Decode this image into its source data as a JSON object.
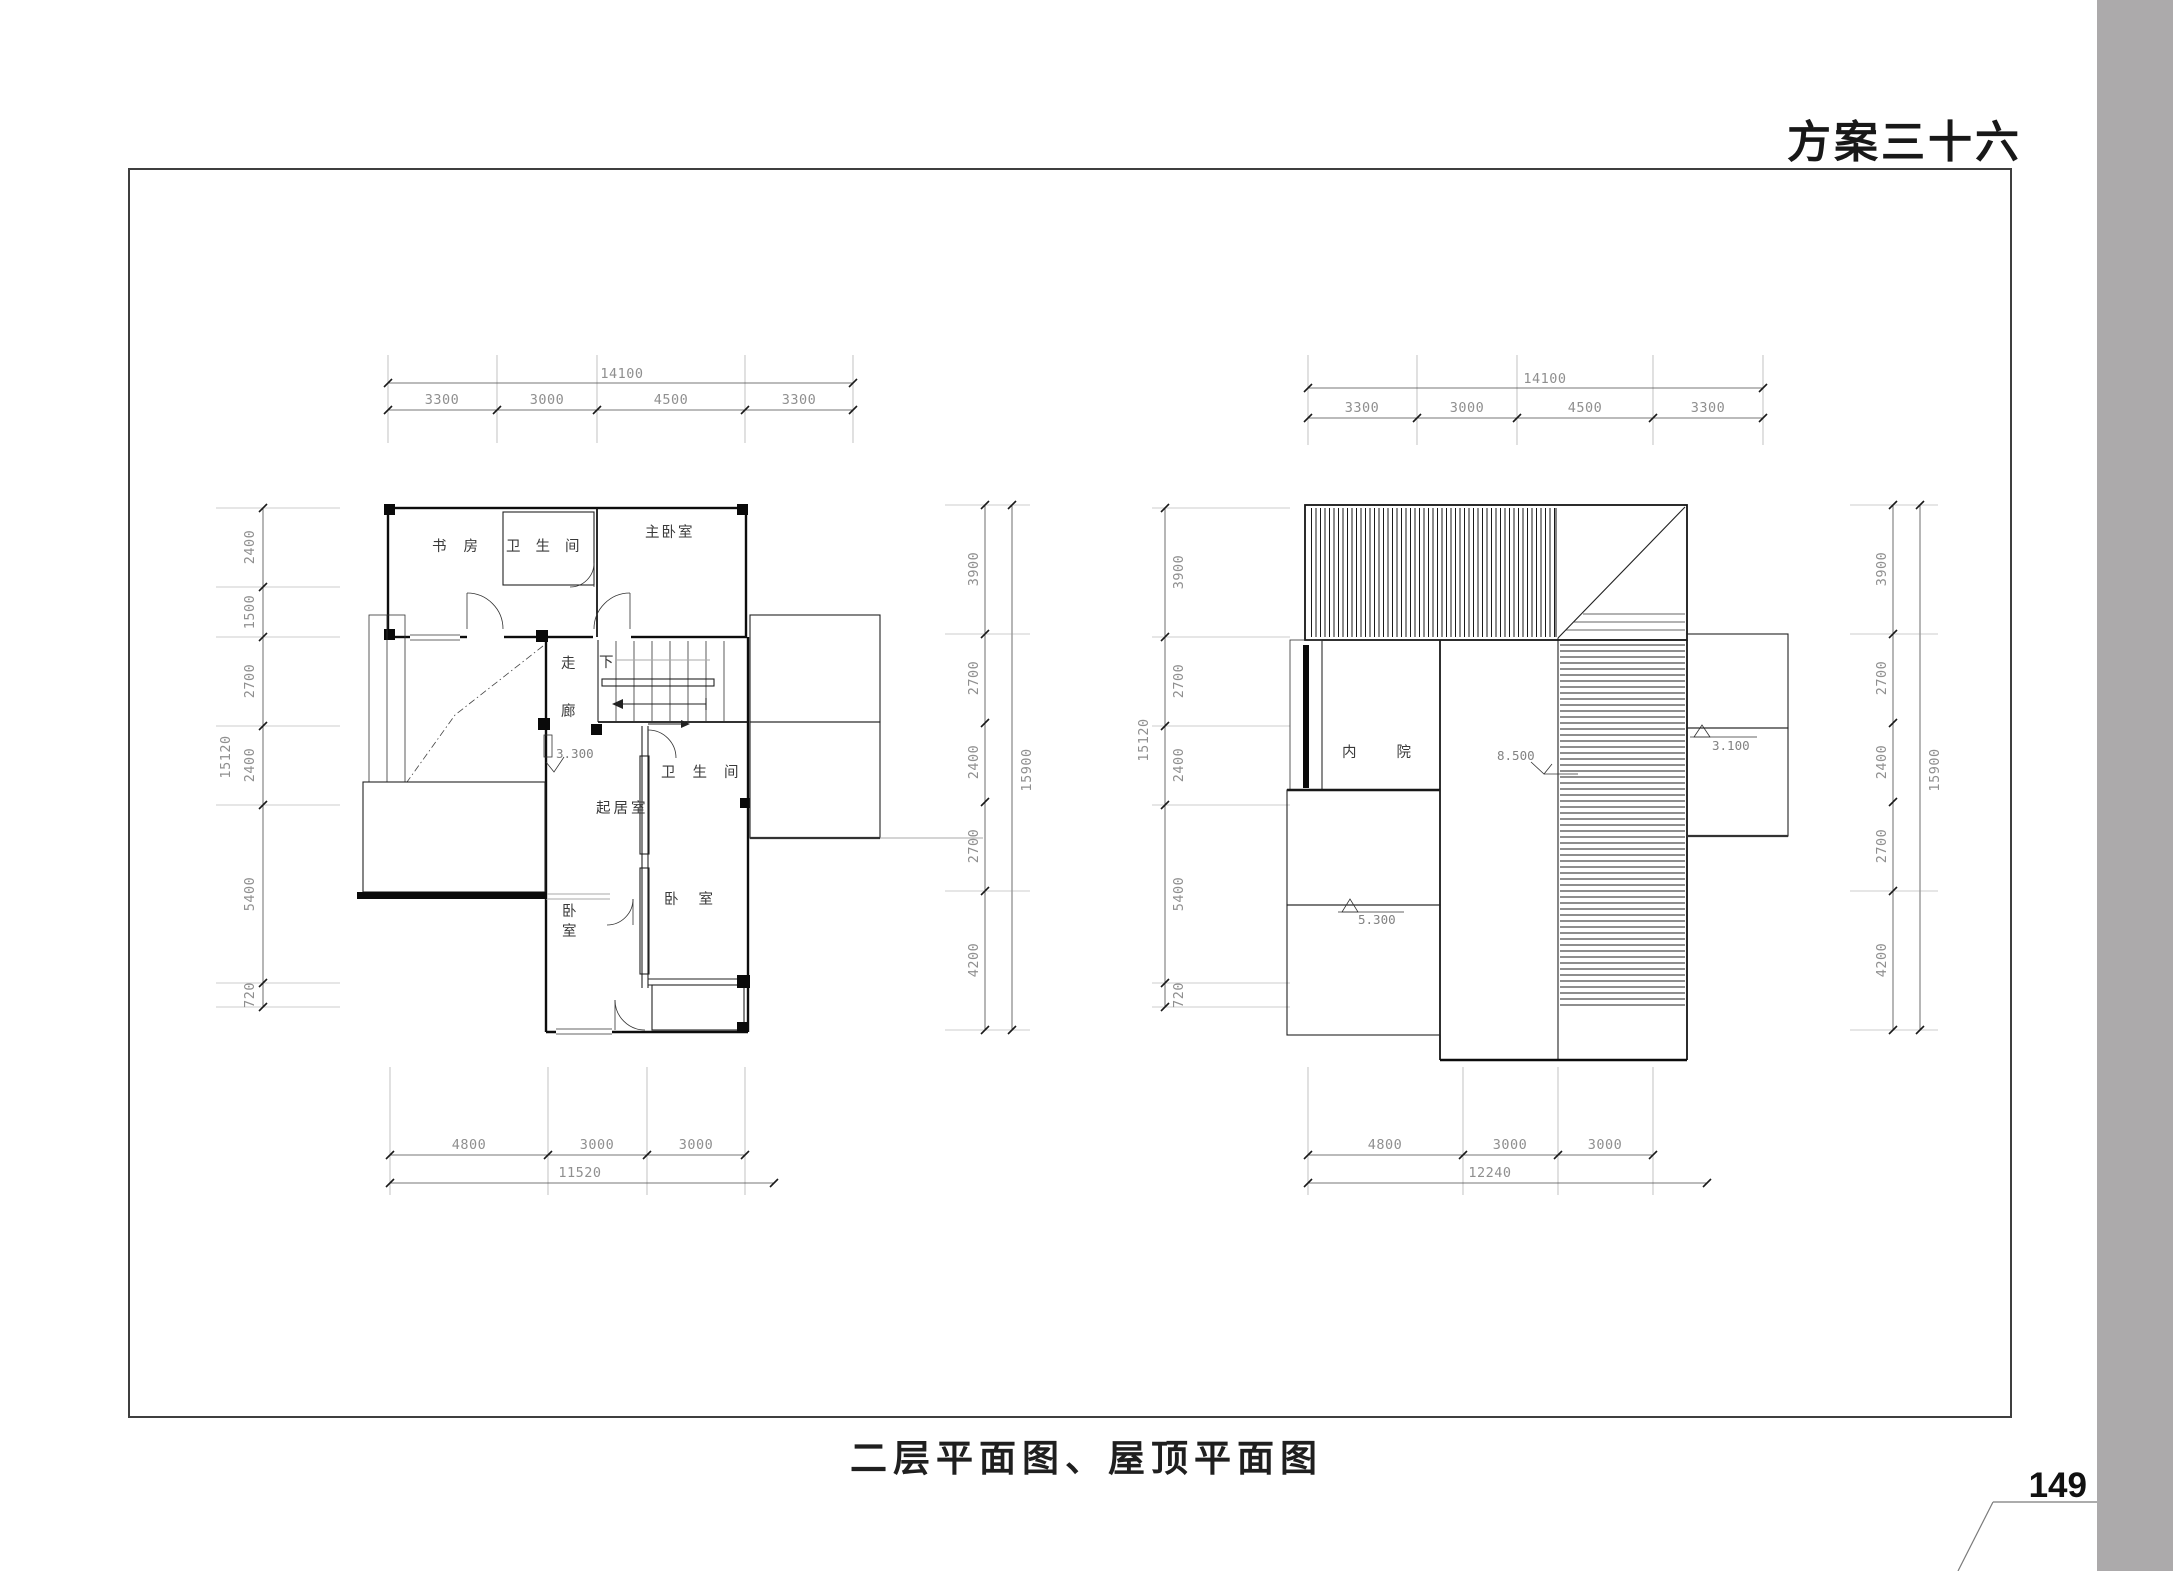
{
  "page": {
    "title": "方案三十六",
    "caption": "二层平面图、屋顶平面图",
    "page_number": "149",
    "accent_gray": "#acaaab"
  },
  "floor_plan": {
    "name": "二层平面图",
    "dims_top": {
      "total": "14100",
      "segments": [
        "3300",
        "3000",
        "4500",
        "3300"
      ]
    },
    "dims_left": {
      "total": "15120",
      "segments": [
        "2400",
        "1500",
        "2700",
        "2400",
        "5400",
        "720"
      ]
    },
    "dims_right": {
      "total": "15900",
      "segments": [
        "3900",
        "2700",
        "2400",
        "2700",
        "4200"
      ]
    },
    "dims_bottom": {
      "total": "11520",
      "segments": [
        "4800",
        "3000",
        "3000"
      ]
    },
    "rooms": {
      "study": "书房",
      "bath_top": "卫生间",
      "master_bedroom": "主卧室",
      "bath": "卫生间",
      "living": "起居室",
      "bedroom_right": "卧室",
      "bedroom_left_1": "卧",
      "bedroom_left_2": "室",
      "corridor_1": "走",
      "corridor_2": "廊",
      "stair_down": "下"
    },
    "levels": {
      "landing": "3.300"
    }
  },
  "roof_plan": {
    "name": "屋顶平面图",
    "dims_top": {
      "total": "14100",
      "segments": [
        "3300",
        "3000",
        "4500",
        "3300"
      ]
    },
    "dims_left": {
      "total": "15120",
      "segments": [
        "3900",
        "2700",
        "2400",
        "5400",
        "720"
      ]
    },
    "dims_right": {
      "total": "15900",
      "segments": [
        "3900",
        "2700",
        "2400",
        "2700",
        "4200"
      ]
    },
    "dims_bottom": {
      "total": "12240",
      "segments": [
        "4800",
        "3000",
        "3000"
      ]
    },
    "labels": {
      "courtyard": "内院",
      "level_ridge": "8.500",
      "level_left": "5.300",
      "level_right": "3.100"
    }
  }
}
